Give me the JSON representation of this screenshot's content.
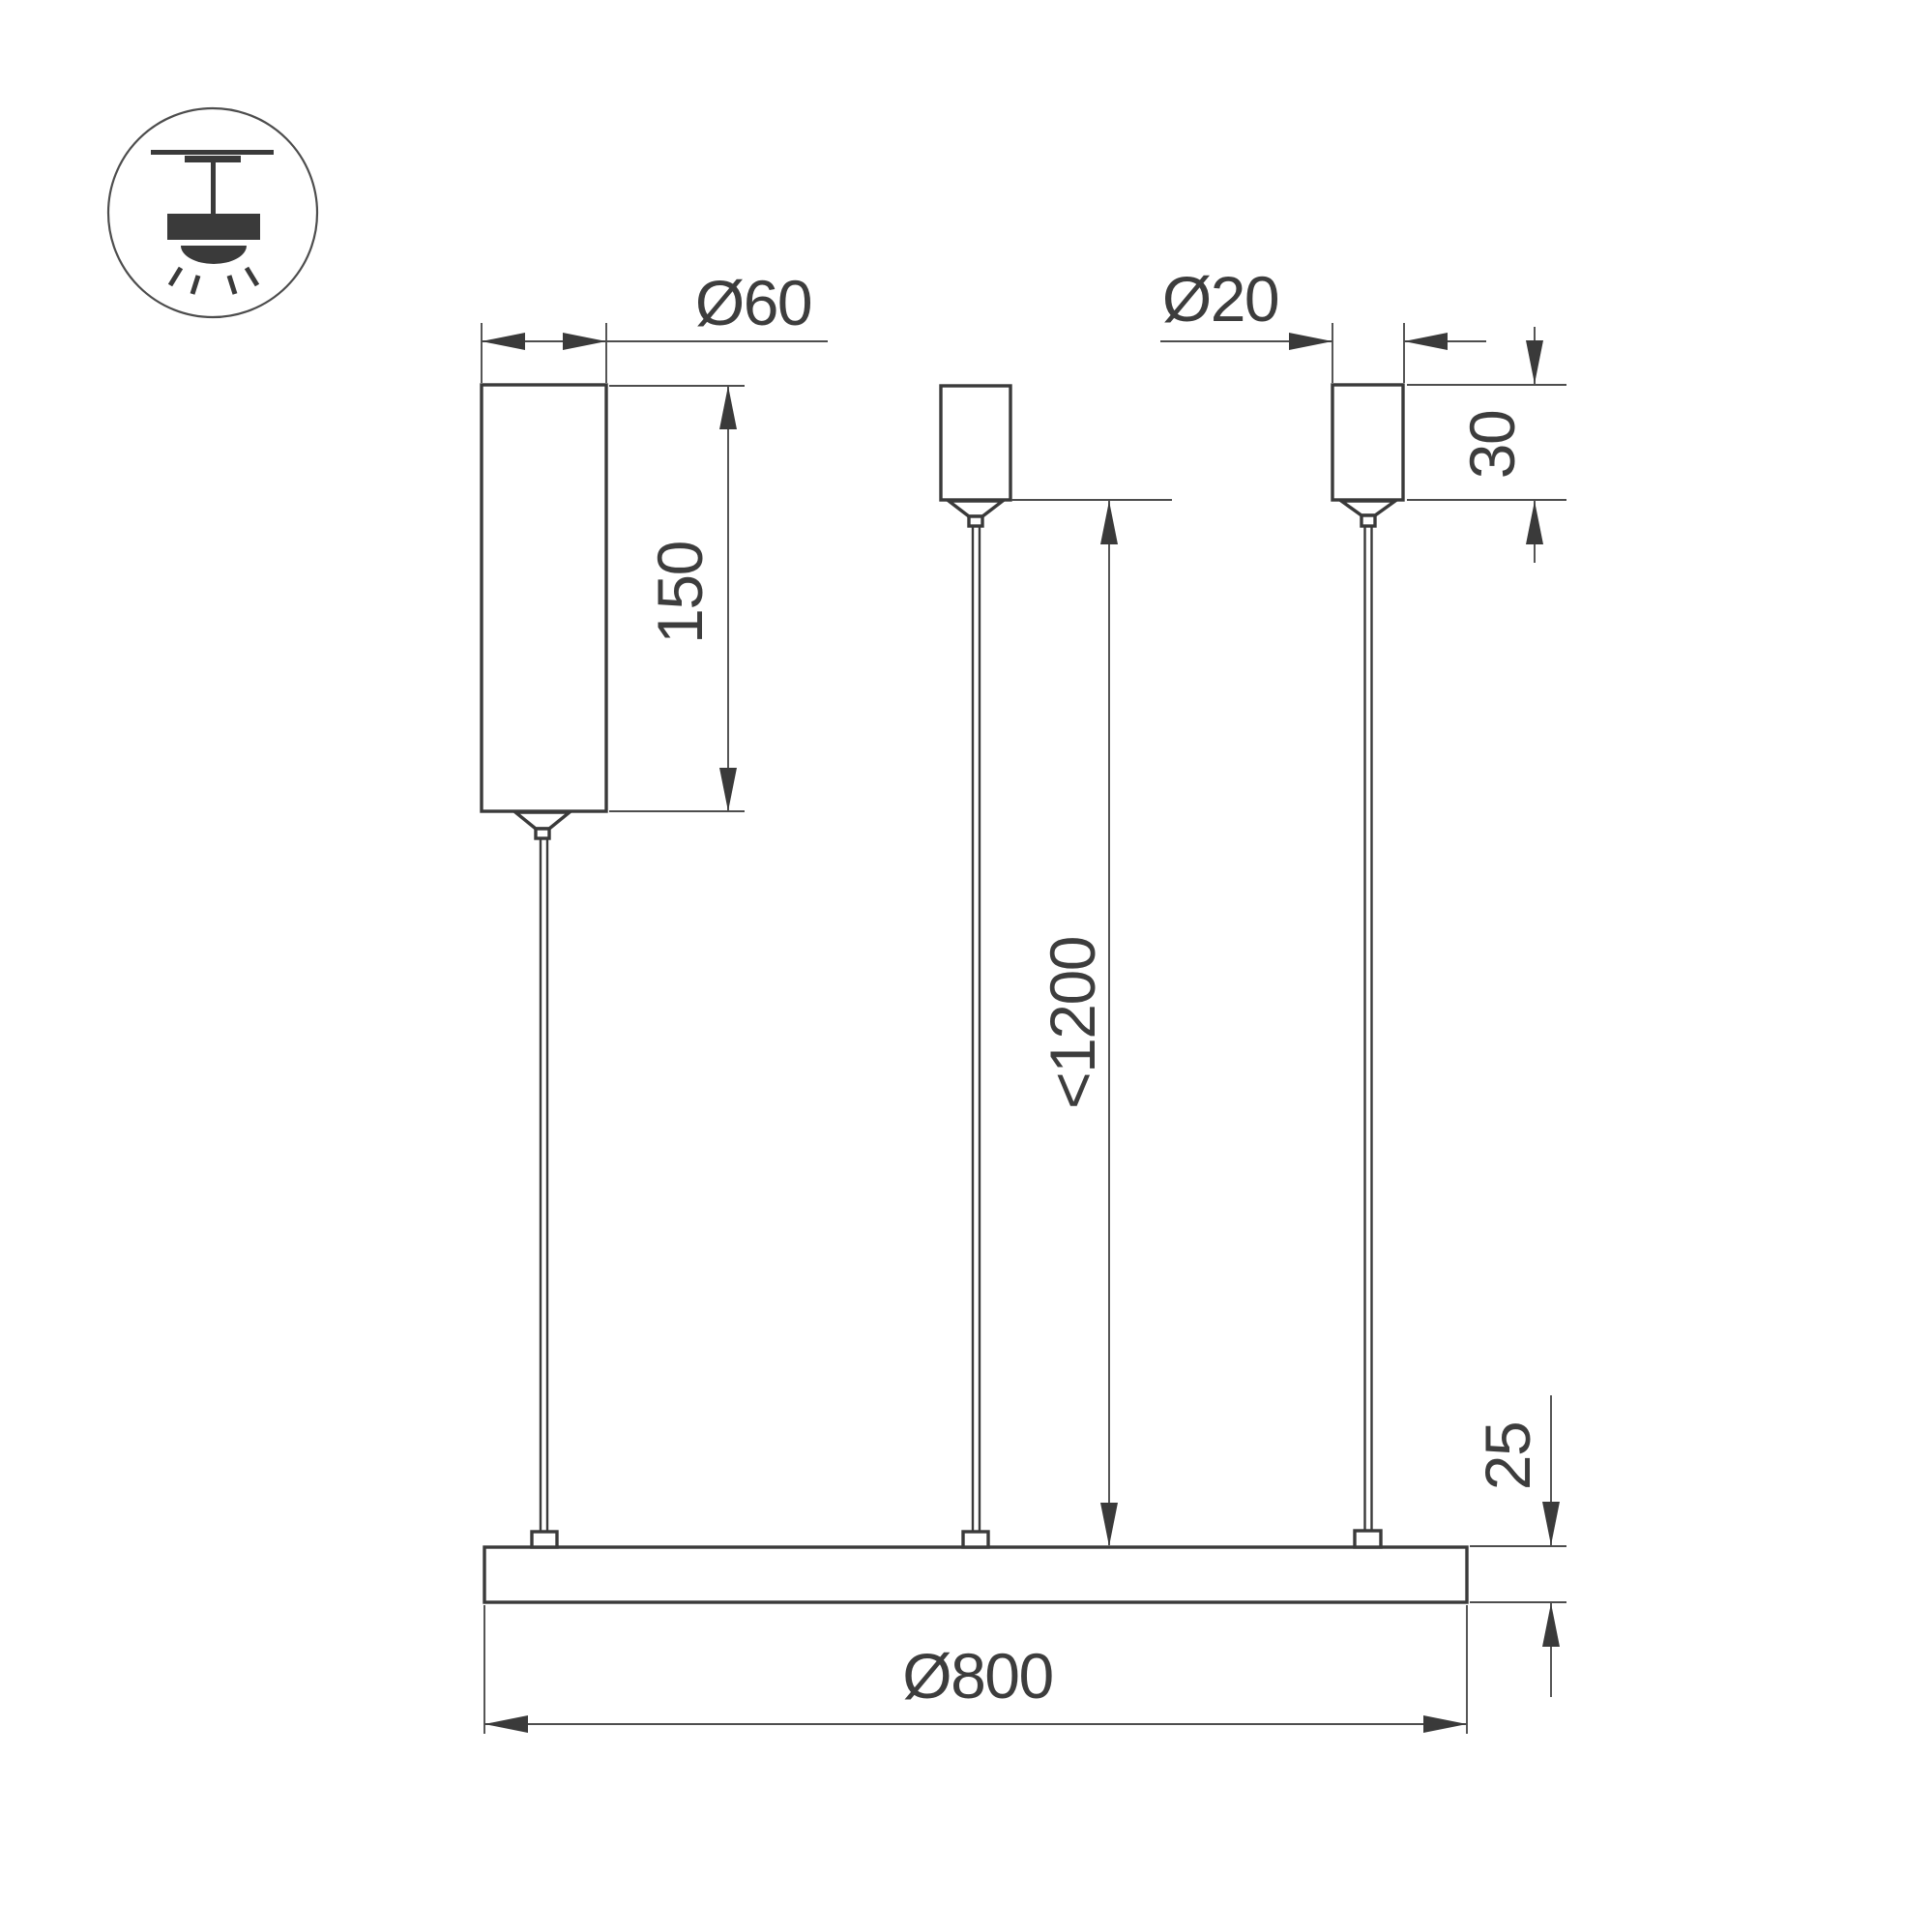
{
  "colors": {
    "bg": "#ffffff",
    "line": "#3a3a3a",
    "thin": "#4d4d4d",
    "text": "#3d3d3d"
  },
  "icon": {
    "name": "pendant-ceiling-mount-icon"
  },
  "dimensions": {
    "driver_diameter": "Ø60",
    "driver_length": "150",
    "canopy_diameter": "Ø20",
    "canopy_height": "30",
    "suspension_length": "<1200",
    "fixture_thickness": "25",
    "fixture_diameter": "Ø800"
  }
}
